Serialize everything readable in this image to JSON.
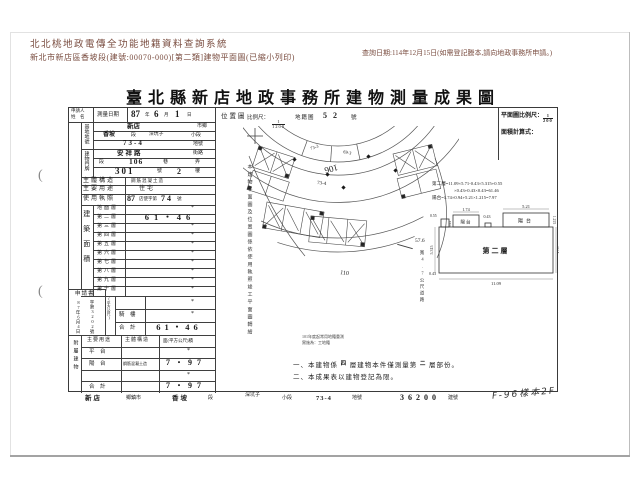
{
  "page": {
    "system_title": "北北桃地政電傳全功能地籍資料查詢系統",
    "subtitle": "新北市新店區香坡段(建號:00070-000)[第二類]建物平面圖(已縮小列印)",
    "query_note": "查詢日期:114年12月15日(如需登記謄本,請向地政事務所申請。)",
    "doc_title": "臺北縣新店地政事務所建物測量成果圖"
  },
  "decor": {
    "punch": "("
  },
  "form": {
    "applicant_label_1": "申請人",
    "applicant_label_2": "姓　名",
    "survey_date_label": "測量日期",
    "survey_date": {
      "y": "87",
      "yu": "年",
      "m": "6",
      "mu": "月",
      "d": "1",
      "du": "日"
    },
    "land": {
      "section_label": "基地地號",
      "row1": {
        "v": "新店",
        "l": "市鄉"
      },
      "row2": {
        "v": "香坡",
        "l": "段",
        "v2": "深坑子",
        "l2": "小段"
      },
      "row3": {
        "v": "73-4",
        "l": "地號"
      }
    },
    "door": {
      "section_label": "建物門牌",
      "row1": {
        "v": "安祥路",
        "l": "街路"
      },
      "row2": {
        "l1": "段",
        "v": "106",
        "l2": "巷",
        "l3": "弄"
      },
      "row3": {
        "v": "301",
        "l1": "號",
        "v2": "2",
        "l2": "樓"
      }
    },
    "structure_label": "主體構造",
    "structure_value": "鋼筋混凝土造",
    "usage_label": "主要用途",
    "usage_value": "住宅",
    "license_label": "使用執照",
    "license": {
      "a": "87",
      "b": "店使字第",
      "c": "74",
      "d": "號"
    },
    "area_label": "建築面積",
    "area_unit": "(平方公尺)",
    "floors": [
      {
        "label": "地面層",
        "value": "*"
      },
      {
        "label": "第二層",
        "value": "61・46"
      },
      {
        "label": "第三層",
        "value": "*"
      },
      {
        "label": "第四層",
        "value": "*"
      },
      {
        "label": "第五層",
        "value": "*"
      },
      {
        "label": "第六層",
        "value": "*"
      },
      {
        "label": "第七層",
        "value": "*"
      },
      {
        "label": "第八層",
        "value": "*"
      },
      {
        "label": "第九層",
        "value": "*"
      },
      {
        "label": "第十層",
        "value": "*"
      },
      {
        "label": "",
        "value": "*"
      },
      {
        "label": "騎　樓",
        "value": "*"
      },
      {
        "label": "合　計",
        "value": "61・46"
      }
    ],
    "application": {
      "title": "申請書",
      "date": "87年6月4日",
      "number": "字第3202號"
    },
    "attached": {
      "section_label": "附屬建物",
      "headers": [
        "主要用途",
        "主體構造",
        "面(平方公尺)積"
      ],
      "rows": [
        {
          "use": "平　台",
          "structure": "",
          "area": "*"
        },
        {
          "use": "陽　台",
          "structure": "鋼筋混凝土造",
          "area": "7・97"
        },
        {
          "use": "",
          "structure": "",
          "area": "*"
        },
        {
          "use": "合　計",
          "structure": "",
          "area": "7・97"
        }
      ]
    }
  },
  "location": {
    "title": "位置圖",
    "scale_label": "比例尺：",
    "scale_num": "1",
    "scale_den": "1200",
    "ref_label": "地籍圖",
    "ref_no": "52",
    "ref_suffix": "號",
    "road_no": "106",
    "parcel_a": "73-3",
    "parcel_b": "69-3",
    "parcel_main": "73-4",
    "outer_no": "110",
    "dist": "57.6",
    "dist_note": "寬4.7公尺道路"
  },
  "plan": {
    "scale_label": "平面圖比例尺：",
    "scale_num": "1",
    "scale_den": "200",
    "calc_label": "面積計算式：",
    "formula1": "第二層=11.09×5.71-0.43×5.315+0.55",
    "formula2": "×0.43+0.43×0.43=61.46",
    "formula3": "陽台=1.74×0.94+5.21×1.215=7.97",
    "floor_label": "第二層",
    "balcony_label": "陽台",
    "balcony_label2": "陽台",
    "dims": {
      "d055": "0.55",
      "d174": "1.74",
      "d094": "0.94",
      "d043": "0.43",
      "d521": "5.21",
      "d1215": "1.215",
      "d5315": "5.315",
      "d043b": "0.43",
      "d1109": "11.09",
      "d571": "5.71"
    }
  },
  "annotations": {
    "left_vertical": "本建物平面圖及位置圖係依使用執照竣工平面圖轉繪",
    "stamp_line1": "101年度起常用地籍重測",
    "stamp_line2": "實施為：工地籍",
    "note1_a": "一、本建物係",
    "note1_b": "四",
    "note1_c": "層建物本件僅測量第",
    "note1_d": "二",
    "note1_e": "層部份。",
    "note2": "二、本成果表以建物登記為限。"
  },
  "footer": {
    "items": [
      {
        "v": "新店",
        "l": "鄉鎮市"
      },
      {
        "v": "香坡",
        "l": "段"
      },
      {
        "v": "深坑子",
        "l": "小段"
      },
      {
        "v": "73-4",
        "l": "地號"
      },
      {
        "v": "36200",
        "l": "建號"
      }
    ],
    "handwritten": "F-96樣本2F"
  }
}
